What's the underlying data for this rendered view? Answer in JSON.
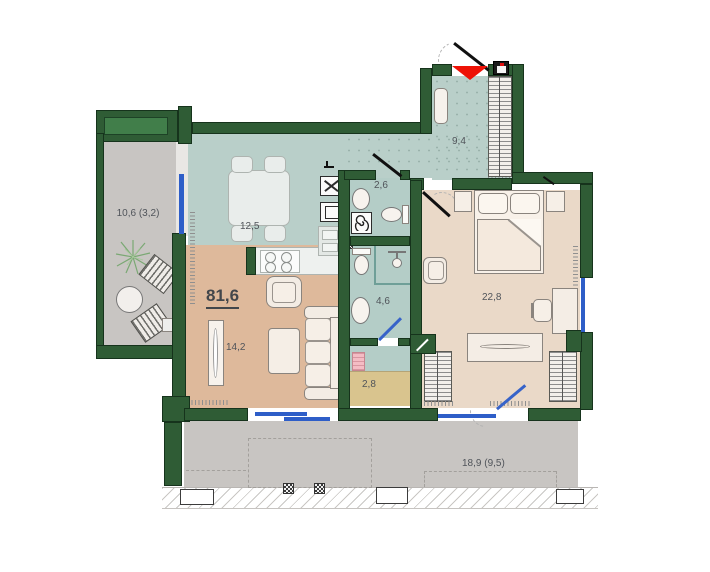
{
  "plan": {
    "total_area": {
      "label": "81,6"
    },
    "rooms": [
      {
        "name": "balcony-left",
        "label": "10,6 (3,2)"
      },
      {
        "name": "kitchen-dining",
        "label": "12,5"
      },
      {
        "name": "hallway",
        "label": "9,4"
      },
      {
        "name": "bathroom-guest",
        "label": "2,6"
      },
      {
        "name": "bathroom-main",
        "label": "4,6"
      },
      {
        "name": "living-room",
        "label": "14,2"
      },
      {
        "name": "bedroom",
        "label": "22,8"
      },
      {
        "name": "storage",
        "label": "2,8"
      },
      {
        "name": "terrace",
        "label": "18,9 (9,5)"
      }
    ],
    "colors": {
      "wall": "#2f5c35",
      "window": "#2e5ec8",
      "entrance_marker": "#ee1206",
      "floor_kitchen": "#b9cfc9",
      "floor_living": "#deb99b",
      "floor_bedroom": "#ead9c8",
      "floor_bath": "#b4cdc7",
      "floor_storage": "#d9c48e",
      "floor_balcony": "#c8c5c2"
    },
    "icons": [
      "entrance-arrow",
      "door-swing",
      "window",
      "radiator",
      "wardrobe-hatch",
      "floor-drain",
      "electrical-panel",
      "plant",
      "washing-machine",
      "stove",
      "fridge",
      "oven",
      "sink",
      "toilet",
      "shower"
    ]
  }
}
